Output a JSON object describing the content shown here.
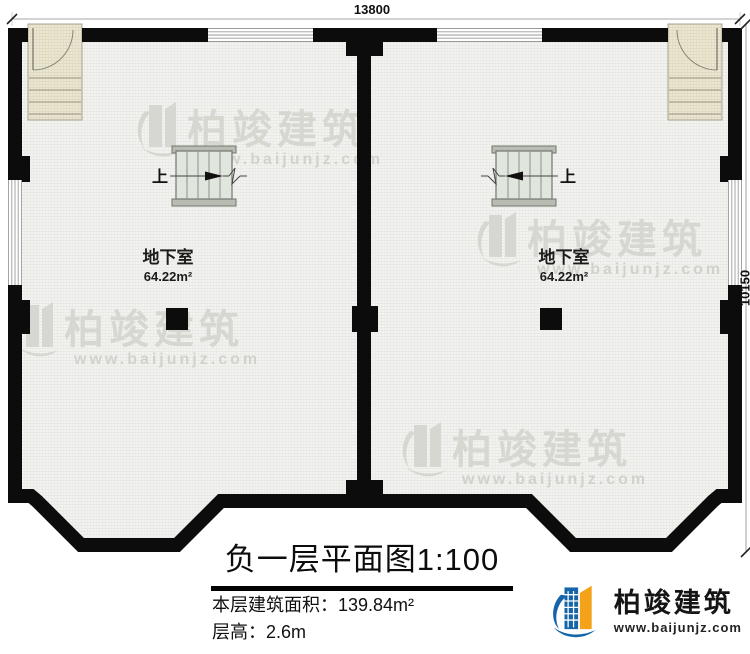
{
  "dimensions": {
    "width_label": "13800",
    "height_label": "10150"
  },
  "rooms": [
    {
      "name": "地下室",
      "area": "64.22m²"
    },
    {
      "name": "地下室",
      "area": "64.22m²"
    }
  ],
  "stairs": {
    "up": "上"
  },
  "title": "负一层平面图1:100",
  "info": {
    "area": "本层建筑面积：139.84m²",
    "floor_height": "层高：2.6m"
  },
  "brand": {
    "name": "柏竣建筑",
    "url": "www.baijunjz.com"
  },
  "watermark": {
    "name": "柏竣建筑",
    "url": "www.baijunjz.com"
  },
  "colors": {
    "wall": "#0c0c0c",
    "stair_fill": "#e0e5dd",
    "entry_fill": "#ebe7d2",
    "brand_blue": "#1665a8",
    "brand_orange": "#f5a21b",
    "watermark_gray": "#d7d7d2"
  }
}
